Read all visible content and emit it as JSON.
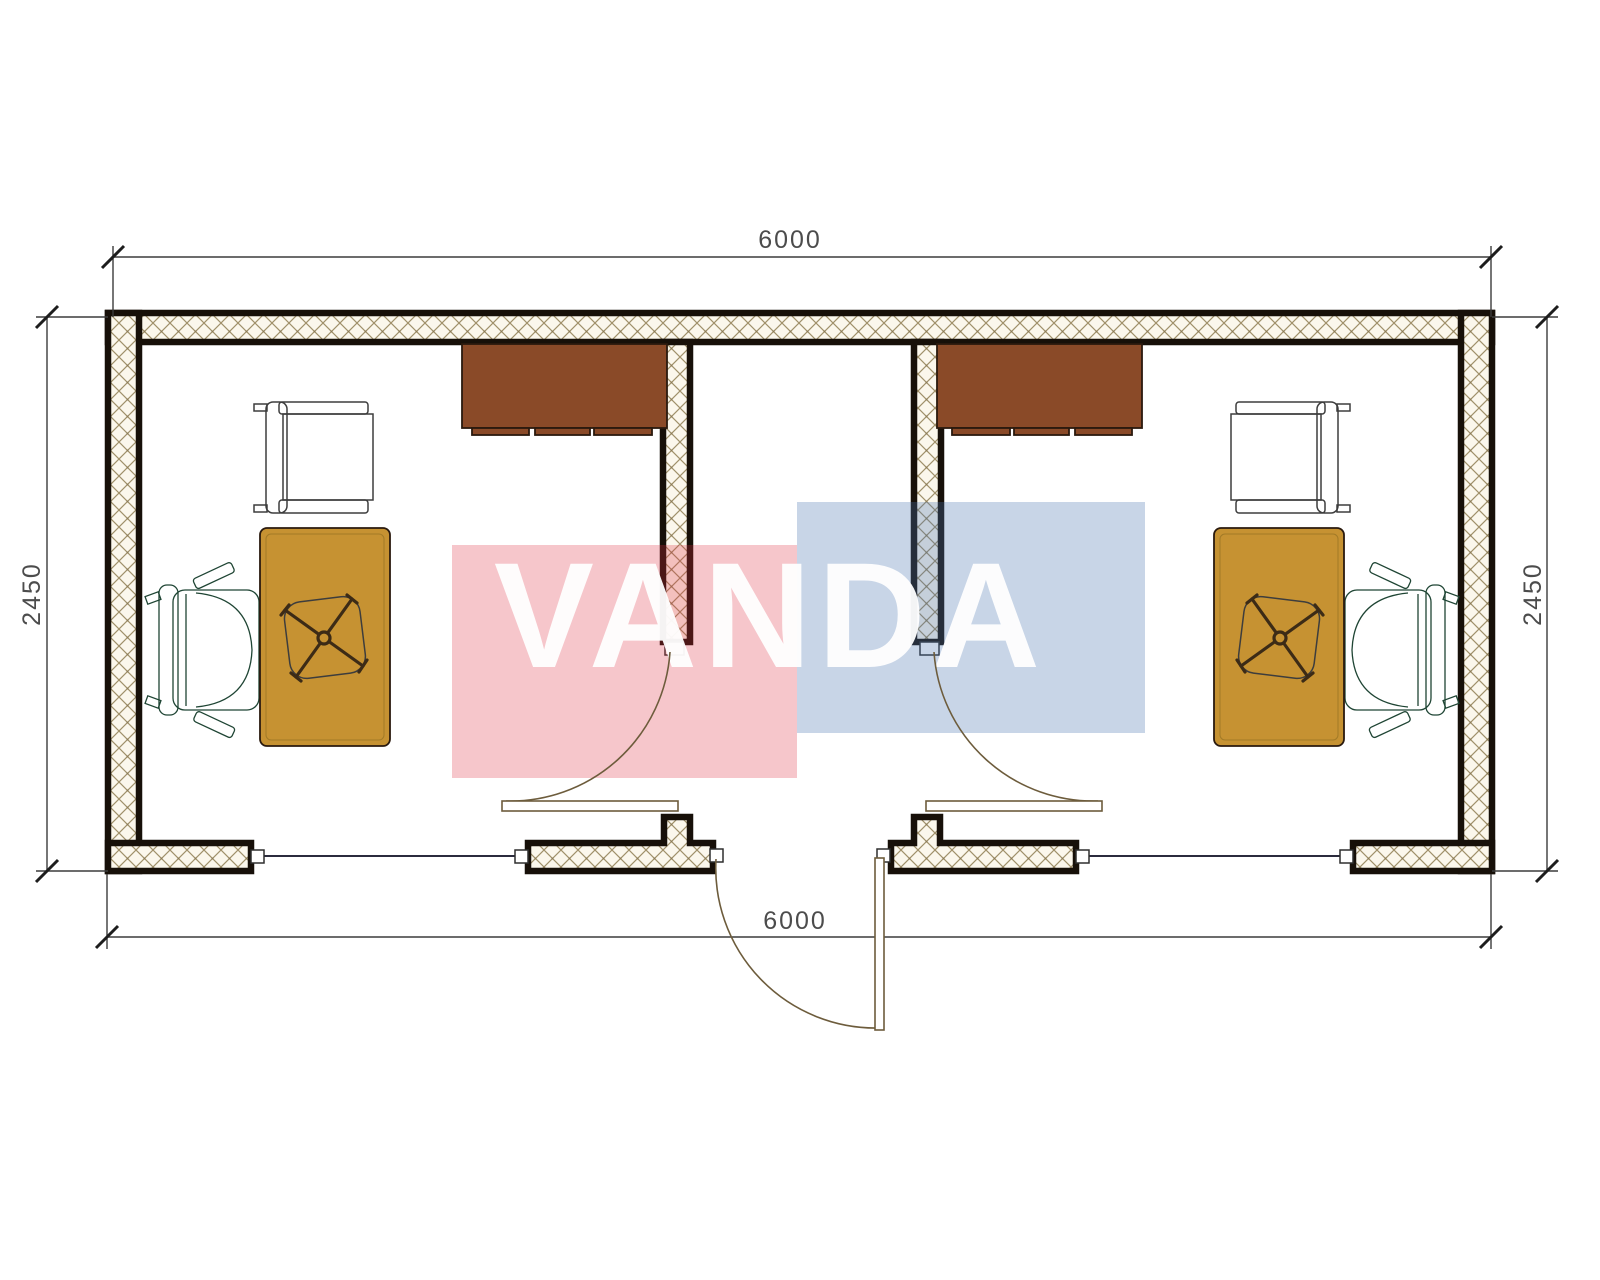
{
  "title": "Container office floor plan",
  "dimensions": {
    "top": "6000",
    "bottom": "6000",
    "left": "2450",
    "right": "2450"
  },
  "watermark": {
    "brand": "VANDA",
    "red_block_color": "rgba(221,44,61,0.27)",
    "blue_block_color": "rgba(73,116,176,0.30)",
    "text_color": "#ffffff"
  },
  "colors": {
    "wall_outline": "#171009",
    "hatch_line": "#a0906a",
    "hatch_bg": "#fbf7ec",
    "cabinet": "#8a4a28",
    "desk": "#c69232",
    "desk_edge": "#8a6a20",
    "guest_chair": "#b3a49a",
    "task_chair": "#5fa284",
    "chair_base": "#3c2b16",
    "door_line": "#6d5c3c",
    "window_line": "#2b2b3d",
    "dim_line": "#3c3c3c",
    "dim_text": "#4c4c4c",
    "frame_fill": "#ffffff"
  },
  "rooms": [
    {
      "id": "office-left",
      "furniture": [
        "wardrobe-cabinet",
        "desk",
        "task-chair",
        "guest-chair"
      ]
    },
    {
      "id": "office-right",
      "furniture": [
        "wardrobe-cabinet",
        "desk",
        "task-chair",
        "guest-chair"
      ]
    }
  ],
  "openings": {
    "windows": 2,
    "room_doors": 2,
    "entrance_doors": 1
  }
}
